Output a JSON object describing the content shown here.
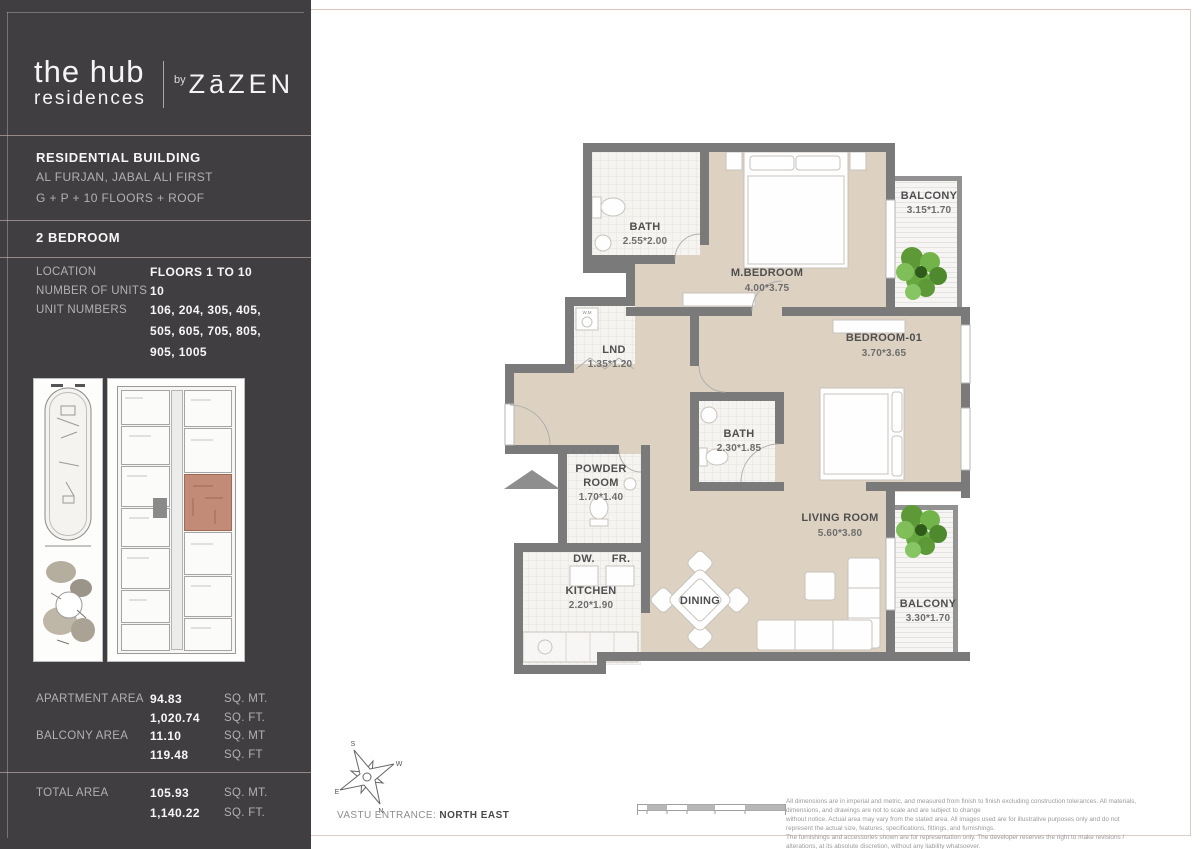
{
  "brand": {
    "name_line1": "the hub",
    "name_line2": "residences",
    "by": "by",
    "developer": "ZāZEN"
  },
  "building": {
    "title": "RESIDENTIAL BUILDING",
    "address": "AL FURJAN, JABAL ALI FIRST",
    "structure": "G + P + 10 FLOORS + ROOF",
    "unit_type": "2 BEDROOM"
  },
  "details": {
    "location_label": "LOCATION",
    "location_value": "FLOORS 1 TO 10",
    "units_label": "NUMBER OF UNITS",
    "units_value": "10",
    "unit_numbers_label": "UNIT NUMBERS",
    "unit_numbers_line1": "106, 204, 305, 405,",
    "unit_numbers_line2": "505, 605, 705, 805,",
    "unit_numbers_line3": "905, 1005"
  },
  "areas": {
    "apartment_label": "APARTMENT AREA",
    "apartment_m": "94.83",
    "apartment_m_unit": "SQ. MT.",
    "apartment_f": "1,020.74",
    "apartment_f_unit": "SQ. FT.",
    "balcony_label": "BALCONY AREA",
    "balcony_m": "11.10",
    "balcony_m_unit": "SQ. MT",
    "balcony_f": "119.48",
    "balcony_f_unit": "SQ. FT",
    "total_label": "TOTAL AREA",
    "total_m": "105.93",
    "total_m_unit": "SQ. MT.",
    "total_f": "1,140.22",
    "total_f_unit": "SQ. FT."
  },
  "plan": {
    "bath1_name": "BATH",
    "bath1_dims": "2.55*2.00",
    "mbedroom_name": "M.BEDROOM",
    "mbedroom_dims": "4.00*3.75",
    "balcony1_name": "BALCONY",
    "balcony1_dims": "3.15*1.70",
    "lnd_name": "LND",
    "lnd_dims": "1.35*1.20",
    "bedroom01_name": "BEDROOM-01",
    "bedroom01_dims": "3.70*3.65",
    "bath2_name": "BATH",
    "bath2_dims": "2.30*1.85",
    "powder_name1": "POWDER",
    "powder_name2": "ROOM",
    "powder_dims": "1.70*1.40",
    "kitchen_name": "KITCHEN",
    "kitchen_dims": "2.20*1.90",
    "dining_name": "DINING",
    "living_name": "LIVING ROOM",
    "living_dims": "5.60*3.80",
    "balcony2_name": "BALCONY",
    "balcony2_dims": "3.30*1.70",
    "dw": "DW.",
    "fr": "FR.",
    "wm": "W.M",
    "compass_n": "N",
    "compass_s": "S",
    "compass_e": "E",
    "compass_w": "W",
    "vastu_label": "VASTU ENTRANCE:",
    "vastu_value": "NORTH EAST"
  },
  "footer": {
    "disclaimer_line1": "All dimensions are in imperial and metric, and measured from finish to finish excluding construction tolerances. All materials, dimensions, and drawings are not to scale and are subject to change",
    "disclaimer_line2": "without notice. Actual area may vary from the stated area. All images used are for illustrative purposes only and do not represent the actual size, features, specifications, fittings, and furnishings.",
    "disclaimer_line3": "The furnishings and accessories shown are for representation only. The developer reserves the right to make revisions / alterations, at its absolute discretion, without any liability whatsoever."
  },
  "colors": {
    "sidebar_bg": "#413e41",
    "floor_beige": "#ddd2c2",
    "wall_gray": "#7a7a7a",
    "unit_highlight": "#c28b77",
    "plant_green": "#6fae45",
    "divider_pink": "#d8c3bb"
  }
}
